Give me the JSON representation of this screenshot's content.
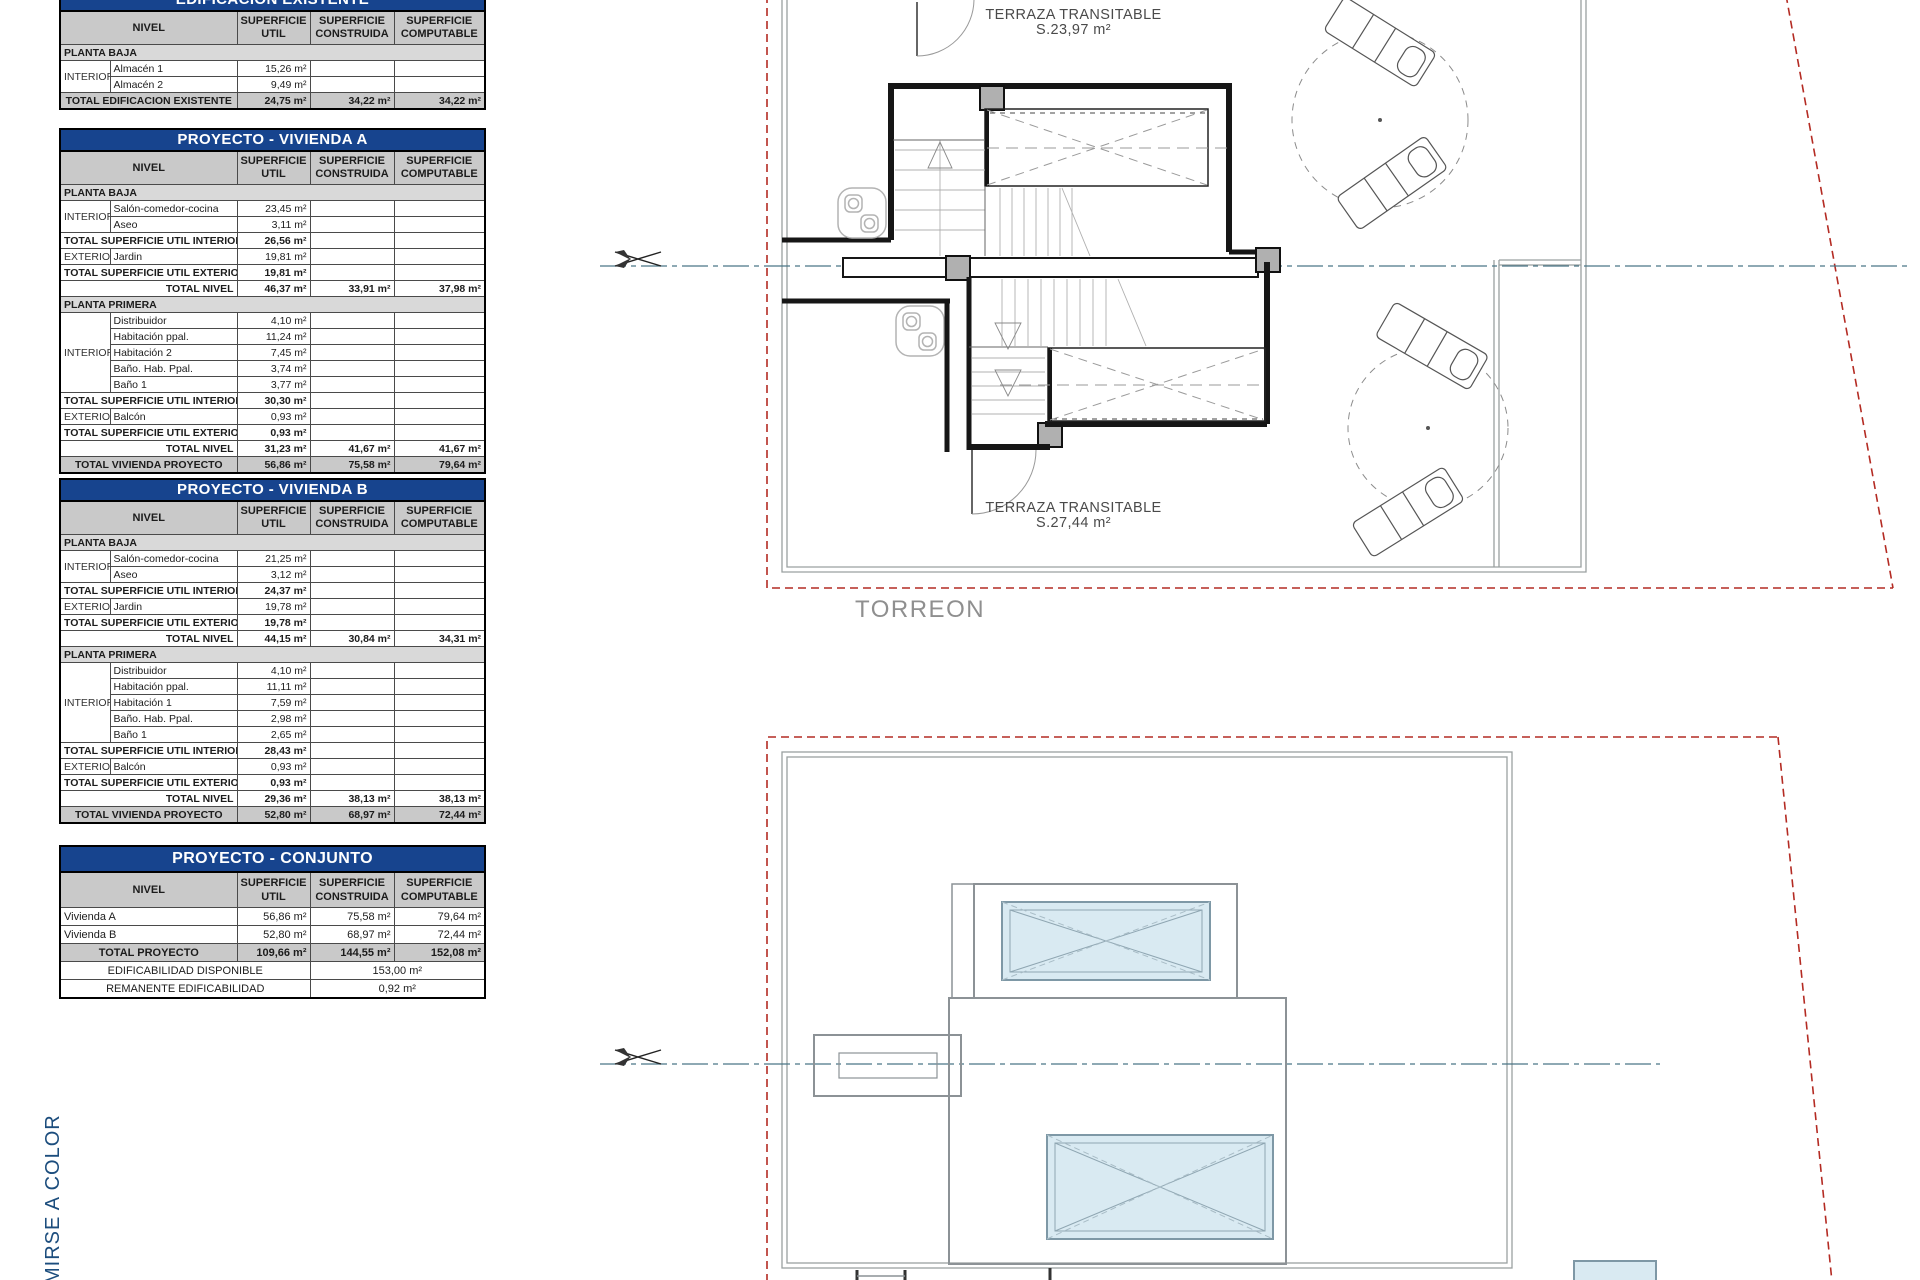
{
  "colors": {
    "table_title_blue": "#17448e",
    "header_gray": "#c9c9c9",
    "section_gray": "#d9d9d9",
    "boundary_red": "#b42b23",
    "centerline_teal": "#4a7686",
    "pool_blue": "#d9eaf2",
    "note_blue": "#1c4d7d",
    "plan_gray": "#8c9296"
  },
  "plan": {
    "terraza_top_1": "TERRAZA TRANSITABLE",
    "terraza_top_2": "S.23,97  m²",
    "terraza_bot_1": "TERRAZA TRANSITABLE",
    "terraza_bot_2": "S.27,44  m²",
    "torreon": "TORREON",
    "side_note": "MIRSE A COLOR"
  },
  "tables": [
    {
      "title": "EDIFICACION EXISTENTE",
      "top": -12,
      "cls": "",
      "header": {
        "nivel": "NIVEL",
        "util": "SUPERFICIE\nUTIL",
        "construida": "SUPERFICIE\nCONSTRUIDA",
        "computable": "SUPERFICIE\nCOMPUTABLE"
      },
      "rows": [
        {
          "t": "sec",
          "label": "PLANTA BAJA"
        },
        {
          "t": "item",
          "group": "INTERIOR",
          "gspan": 2,
          "name": "Almacén 1",
          "v": [
            "15,26 m²",
            "",
            ""
          ]
        },
        {
          "t": "item",
          "name": "Almacén 2",
          "v": [
            "9,49 m²",
            "",
            ""
          ]
        },
        {
          "t": "grand",
          "label": "TOTAL EDIFICACION EXISTENTE",
          "v": [
            "24,75 m²",
            "34,22 m²",
            "34,22 m²"
          ]
        }
      ]
    },
    {
      "title": "PROYECTO - VIVIENDA A",
      "top": 128,
      "cls": "",
      "header": {
        "nivel": "NIVEL",
        "util": "SUPERFICIE\nUTIL",
        "construida": "SUPERFICIE\nCONSTRUIDA",
        "computable": "SUPERFICIE\nCOMPUTABLE"
      },
      "rows": [
        {
          "t": "sec",
          "label": "PLANTA BAJA"
        },
        {
          "t": "item",
          "group": "INTERIOR",
          "gspan": 2,
          "name": "Salón-comedor-cocina",
          "v": [
            "23,45 m²",
            "",
            ""
          ]
        },
        {
          "t": "item",
          "name": "Aseo",
          "v": [
            "3,11 m²",
            "",
            ""
          ]
        },
        {
          "t": "tot",
          "label": "TOTAL SUPERFICIE UTIL INTERIOR",
          "v": [
            "26,56 m²",
            "",
            ""
          ]
        },
        {
          "t": "item",
          "group": "EXTERIOR",
          "gspan": 1,
          "name": "Jardin",
          "v": [
            "19,81 m²",
            "",
            ""
          ]
        },
        {
          "t": "tot",
          "label": "TOTAL SUPERFICIE UTIL EXTERIOR",
          "v": [
            "19,81 m²",
            "",
            ""
          ]
        },
        {
          "t": "nivel",
          "label": "TOTAL NIVEL",
          "v": [
            "46,37 m²",
            "33,91 m²",
            "37,98 m²"
          ]
        },
        {
          "t": "sec",
          "label": "PLANTA PRIMERA"
        },
        {
          "t": "item",
          "group": "INTERIOR",
          "gspan": 5,
          "name": "Distribuidor",
          "v": [
            "4,10 m²",
            "",
            ""
          ]
        },
        {
          "t": "item",
          "name": "Habitación ppal.",
          "v": [
            "11,24 m²",
            "",
            ""
          ]
        },
        {
          "t": "item",
          "name": "Habitación 2",
          "v": [
            "7,45 m²",
            "",
            ""
          ]
        },
        {
          "t": "item",
          "name": "Baño. Hab. Ppal.",
          "v": [
            "3,74 m²",
            "",
            ""
          ]
        },
        {
          "t": "item",
          "name": "Baño 1",
          "v": [
            "3,77 m²",
            "",
            ""
          ]
        },
        {
          "t": "tot",
          "label": "TOTAL SUPERFICIE UTIL INTERIOR",
          "v": [
            "30,30 m²",
            "",
            ""
          ]
        },
        {
          "t": "item",
          "group": "EXTERIOR",
          "gspan": 1,
          "name": "Balcón",
          "v": [
            "0,93 m²",
            "",
            ""
          ]
        },
        {
          "t": "tot",
          "label": "TOTAL SUPERFICIE UTIL EXTERIOR",
          "v": [
            "0,93 m²",
            "",
            ""
          ]
        },
        {
          "t": "nivel",
          "label": "TOTAL NIVEL",
          "v": [
            "31,23 m²",
            "41,67 m²",
            "41,67 m²"
          ]
        },
        {
          "t": "grand",
          "label": "TOTAL VIVIENDA PROYECTO",
          "v": [
            "56,86 m²",
            "75,58 m²",
            "79,64 m²"
          ]
        }
      ]
    },
    {
      "title": "PROYECTO - VIVIENDA B",
      "top": 478,
      "cls": "",
      "header": {
        "nivel": "NIVEL",
        "util": "SUPERFICIE\nUTIL",
        "construida": "SUPERFICIE\nCONSTRUIDA",
        "computable": "SUPERFICIE\nCOMPUTABLE"
      },
      "rows": [
        {
          "t": "sec",
          "label": "PLANTA BAJA"
        },
        {
          "t": "item",
          "group": "INTERIOR",
          "gspan": 2,
          "name": "Salón-comedor-cocina",
          "v": [
            "21,25 m²",
            "",
            ""
          ]
        },
        {
          "t": "item",
          "name": "Aseo",
          "v": [
            "3,12 m²",
            "",
            ""
          ]
        },
        {
          "t": "tot",
          "label": "TOTAL SUPERFICIE UTIL INTERIOR",
          "v": [
            "24,37 m²",
            "",
            ""
          ]
        },
        {
          "t": "item",
          "group": "EXTERIOR",
          "gspan": 1,
          "name": "Jardin",
          "v": [
            "19,78 m²",
            "",
            ""
          ]
        },
        {
          "t": "tot",
          "label": "TOTAL SUPERFICIE UTIL EXTERIOR",
          "v": [
            "19,78 m²",
            "",
            ""
          ]
        },
        {
          "t": "nivel",
          "label": "TOTAL NIVEL",
          "v": [
            "44,15 m²",
            "30,84 m²",
            "34,31 m²"
          ]
        },
        {
          "t": "sec",
          "label": "PLANTA PRIMERA"
        },
        {
          "t": "item",
          "group": "INTERIOR",
          "gspan": 5,
          "name": "Distribuidor",
          "v": [
            "4,10 m²",
            "",
            ""
          ]
        },
        {
          "t": "item",
          "name": "Habitación ppal.",
          "v": [
            "11,11 m²",
            "",
            ""
          ]
        },
        {
          "t": "item",
          "name": "Habitación 1",
          "v": [
            "7,59 m²",
            "",
            ""
          ]
        },
        {
          "t": "item",
          "name": "Baño. Hab. Ppal.",
          "v": [
            "2,98 m²",
            "",
            ""
          ]
        },
        {
          "t": "item",
          "name": "Baño 1",
          "v": [
            "2,65 m²",
            "",
            ""
          ]
        },
        {
          "t": "tot",
          "label": "TOTAL SUPERFICIE UTIL INTERIOR",
          "v": [
            "28,43 m²",
            "",
            ""
          ]
        },
        {
          "t": "item",
          "group": "EXTERIOR",
          "gspan": 1,
          "name": "Balcón",
          "v": [
            "0,93 m²",
            "",
            ""
          ]
        },
        {
          "t": "tot",
          "label": "TOTAL SUPERFICIE UTIL EXTERIOR",
          "v": [
            "0,93 m²",
            "",
            ""
          ]
        },
        {
          "t": "nivel",
          "label": "TOTAL NIVEL",
          "v": [
            "29,36 m²",
            "38,13 m²",
            "38,13 m²"
          ]
        },
        {
          "t": "grand",
          "label": "TOTAL VIVIENDA PROYECTO",
          "v": [
            "52,80 m²",
            "68,97 m²",
            "72,44 m²"
          ]
        }
      ]
    },
    {
      "title": "PROYECTO - CONJUNTO",
      "top": 845,
      "cls": "conj",
      "header": {
        "nivel": "NIVEL",
        "util": "SUPERFICIE\nUTIL",
        "construida": "SUPERFICIE\nCONSTRUIDA",
        "computable": "SUPERFICIE\nCOMPUTABLE"
      },
      "rows": [
        {
          "t": "plain",
          "label": "Vivienda A",
          "v": [
            "56,86 m²",
            "75,58 m²",
            "79,64 m²"
          ]
        },
        {
          "t": "plain",
          "label": "Vivienda B",
          "v": [
            "52,80 m²",
            "68,97 m²",
            "72,44 m²"
          ]
        },
        {
          "t": "grand",
          "label": "TOTAL PROYECTO",
          "v": [
            "109,66 m²",
            "144,55 m²",
            "152,08 m²"
          ]
        },
        {
          "t": "span32",
          "label": "EDIFICABILIDAD DISPONIBLE",
          "value": "153,00 m²"
        },
        {
          "t": "span32",
          "label": "REMANENTE EDIFICABILIDAD",
          "value": "0,92 m²"
        }
      ]
    }
  ]
}
